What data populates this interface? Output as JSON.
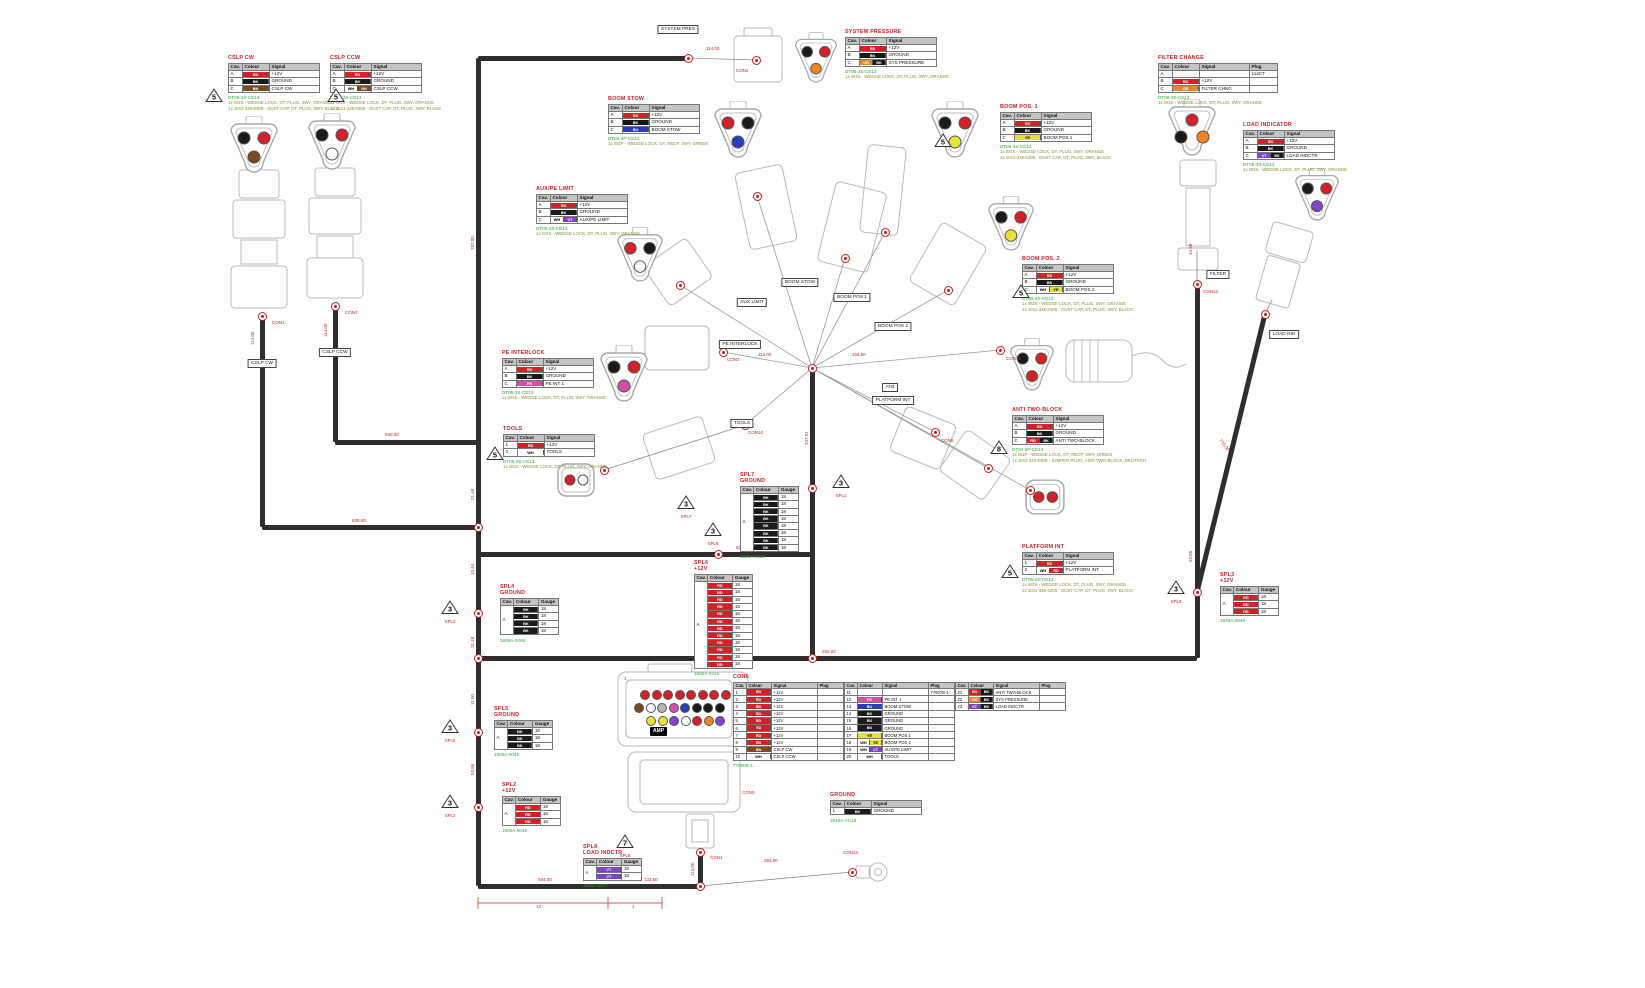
{
  "palette": {
    "RD": "#d22128",
    "BK": "#1a1a1a",
    "BN": "#7a4a21",
    "BU": "#2b3db5",
    "YE": "#e7e33b",
    "OR": "#ef8422",
    "PK": "#d44fa8",
    "VT": "#7e45c8",
    "WH": "#ffffff",
    "GY": "#b5b5b5"
  },
  "headers": {
    "pin": [
      "Cav.",
      "Colour",
      "Signal"
    ],
    "pin_plug": [
      "Cav.",
      "Colour",
      "Signal",
      "Plug"
    ],
    "splice": [
      "Cav.",
      "Colour",
      "Gauge"
    ]
  },
  "pin_tables": [
    {
      "id": "cslp-cw",
      "title": "CSLP CW",
      "x": 228,
      "y": 55,
      "cols": "pin",
      "rows": [
        [
          "A",
          "RD",
          "+12V"
        ],
        [
          "B",
          "BK",
          "GROUND"
        ],
        [
          "C",
          "BN",
          "CSLP CW"
        ]
      ],
      "part": "DT06-3S-CE13",
      "notes": [
        "1x W3S - WEDGE LOCK, DT, PLUG, 3WY, ORANGE",
        "1x 1011-345-0305 - DUST CAP, DT, PLUG, 3WY, BLACK"
      ]
    },
    {
      "id": "cslp-ccw",
      "title": "CSLP CCW",
      "x": 330,
      "y": 55,
      "cols": "pin",
      "rows": [
        [
          "A",
          "RD",
          "+12V"
        ],
        [
          "B",
          "BK",
          "GROUND"
        ],
        [
          "C",
          "WH/BN",
          "CSLP CCW"
        ]
      ],
      "part": "DT06-3S-CE13",
      "notes": [
        "1x W3S - WEDGE LOCK, DT, PLUG, 3WY, ORANGE",
        "1x 1011-345-0305 - DUST CAP, DT, PLUG, 3WY, BLACK"
      ]
    },
    {
      "id": "system-pressure",
      "title": "SYSTEM PRESSURE",
      "x": 845,
      "y": 29,
      "cols": "pin",
      "rows": [
        [
          "A",
          "RD",
          "+12V"
        ],
        [
          "B",
          "BK",
          "GROUND"
        ],
        [
          "C",
          "OR/BK",
          "SYS PRESSURE"
        ]
      ],
      "part": "DT06-3S-CE13",
      "notes": [
        "1x W3S - WEDGE LOCK, DT, PLUG, 3WY, ORANGE"
      ]
    },
    {
      "id": "boom-stow",
      "title": "BOOM STOW",
      "x": 608,
      "y": 96,
      "cols": "pin",
      "rows": [
        [
          "A",
          "RD",
          "+12V"
        ],
        [
          "B",
          "BK",
          "GROUND"
        ],
        [
          "C",
          "BU",
          "BOOM STOW"
        ]
      ],
      "part": "DT04-3P-CE13",
      "notes": [
        "1x W3P - WEDGE LOCK, DT, RECP, 3WY, GREEN"
      ]
    },
    {
      "id": "boom-pos-1",
      "title": "BOOM POS. 1",
      "x": 1000,
      "y": 104,
      "cols": "pin",
      "rows": [
        [
          "A",
          "RD",
          "+12V"
        ],
        [
          "B",
          "BK",
          "GROUND"
        ],
        [
          "C",
          "YE",
          "BOOM POS 1"
        ]
      ],
      "part": "DT06-3S-CE13",
      "notes": [
        "1x W3S - WEDGE LOCK, DT, PLUG, 3WY, ORANGE",
        "1x 1011-345-0305 - DUST CAP, DT, PLUG, 3WY, BLACK"
      ]
    },
    {
      "id": "boom-pos-2",
      "title": "BOOM POS. 2",
      "x": 1022,
      "y": 256,
      "cols": "pin",
      "rows": [
        [
          "A",
          "RD",
          "+12V"
        ],
        [
          "B",
          "BK",
          "GROUND"
        ],
        [
          "C",
          "WH/YE",
          "BOOM POS 2"
        ]
      ],
      "part": "DT06-3S-CE13",
      "notes": [
        "1x W3S - WEDGE LOCK, DT, PLUG, 3WY, ORANGE",
        "1x 1011-345-0305 - DUST CAP, DT, PLUG, 3WY, BLACK"
      ]
    },
    {
      "id": "aux-pe-limit",
      "title": "AUX/PE LIMIT",
      "x": 536,
      "y": 186,
      "cols": "pin",
      "rows": [
        [
          "A",
          "RD",
          "+12V"
        ],
        [
          "B",
          "BK",
          "GROUND"
        ],
        [
          "C",
          "WH/VT",
          "AUX/PE LIMIT"
        ]
      ],
      "part": "DT06-3S-CE13",
      "notes": [
        "1x W3S - WEDGE LOCK, DT, PLUG, 3WY, ORANGE"
      ]
    },
    {
      "id": "pe-interlock",
      "title": "PE INTERLOCK",
      "x": 502,
      "y": 350,
      "cols": "pin",
      "rows": [
        [
          "A",
          "RD",
          "+12V"
        ],
        [
          "B",
          "BK",
          "GROUND"
        ],
        [
          "C",
          "PK",
          "PE INT 1"
        ]
      ],
      "part": "DT06-3S-CE13",
      "notes": [
        "1x W3S - WEDGE LOCK, DT, PLUG, 3WY, ORANGE"
      ]
    },
    {
      "id": "tools",
      "title": "TOOLS",
      "x": 503,
      "y": 426,
      "cols": "pin",
      "rows": [
        [
          "1",
          "RD",
          "+12V"
        ],
        [
          "2",
          "WH",
          "TOOLS"
        ]
      ],
      "part": "DT06-2S-CE13",
      "notes": [
        "1x W2S - WEDGE LOCK, DT, PLUG, 2WY, ORANGE"
      ]
    },
    {
      "id": "filter-change",
      "title": "FILTER CHANGE",
      "x": 1158,
      "y": 55,
      "cols": "pin_plug",
      "rows": [
        [
          "A",
          "",
          "",
          "114CT"
        ],
        [
          "B",
          "RD",
          "+12V",
          ""
        ],
        [
          "C",
          "OR",
          "FILTER CHNG",
          ""
        ]
      ],
      "part": "DT06-3S-CE13",
      "notes": [
        "1x W3S - WEDGE LOCK, DT, PLUG, 3WY, ORANGE"
      ]
    },
    {
      "id": "load-indicator",
      "title": "LOAD INDICATOR",
      "x": 1243,
      "y": 122,
      "cols": "pin",
      "rows": [
        [
          "A",
          "RD",
          "+12V"
        ],
        [
          "B",
          "BK",
          "GROUND"
        ],
        [
          "C",
          "VT/BK",
          "LOAD INDCTR"
        ]
      ],
      "part": "DT06-3S-CE13",
      "notes": [
        "1x W3S - WEDGE LOCK, DT, PLUG, 3WY, ORANGE"
      ]
    },
    {
      "id": "anti-two-block",
      "title": "ANTI TWO-BLOCK",
      "x": 1012,
      "y": 407,
      "cols": "pin",
      "rows": [
        [
          "A",
          "RD",
          "+12V"
        ],
        [
          "B",
          "BK",
          "GROUND"
        ],
        [
          "C",
          "RD/BK",
          "ANTI TWO-BLOCK"
        ]
      ],
      "part": "DT04-3P-CE13",
      "notes": [
        "1x W3P - WEDGE LOCK, DT, RECP, 3WY, GREEN",
        "1x 1011-343-0305 - JUMPER PLUG, ANTI TWO-BLOCK, DEUTSCH"
      ]
    },
    {
      "id": "platform-int",
      "title": "PLATFORM INT",
      "x": 1022,
      "y": 544,
      "cols": "pin",
      "rows": [
        [
          "1",
          "RD",
          "+12V"
        ],
        [
          "2",
          "WH/RD",
          "PLATFORM INT"
        ]
      ],
      "part": "DT06-2S-CE13",
      "notes": [
        "1x W2S - WEDGE LOCK, DT, PLUG, 2WY, ORANGE",
        "1x 1011-345-0205 - DUST CAP, DT, PLUG, 2WY, BLACK"
      ]
    },
    {
      "id": "ground",
      "title": "GROUND",
      "x": 830,
      "y": 792,
      "cols": "pin",
      "rows": [
        [
          "1",
          "BK",
          "GROUND"
        ]
      ],
      "part": "1916A-YC18",
      "notes": []
    }
  ],
  "splice_tables": [
    {
      "id": "spl4",
      "title": "SPL4",
      "subtitle": "GROUND",
      "x": 500,
      "y": 584,
      "cav": "A",
      "colour": "BK",
      "gauge": "18",
      "count": 4,
      "part": "1926A-0046"
    },
    {
      "id": "spl5",
      "title": "SPL5",
      "subtitle": "GROUND",
      "x": 494,
      "y": 706,
      "cav": "A",
      "colour": "BK",
      "gauge": "18",
      "count": 3,
      "part": "1926A-0046"
    },
    {
      "id": "spl2",
      "title": "SPL2",
      "subtitle": "+12V",
      "x": 502,
      "y": 782,
      "cav": "A",
      "colour": "RD",
      "gauge": "18",
      "count": 3,
      "part": "1926A-0046"
    },
    {
      "id": "spl6",
      "title": "SPL6",
      "subtitle": "+12V",
      "x": 694,
      "y": 560,
      "cav": "A",
      "colour": "RD",
      "gauge": "18",
      "count": 12,
      "part": "1926A-0316"
    },
    {
      "id": "spl7",
      "title": "SPL7",
      "subtitle": "GROUND",
      "x": 740,
      "y": 472,
      "cav": "A",
      "colour": "BK",
      "gauge": "18",
      "count": 8,
      "part": "1926A-0316"
    },
    {
      "id": "spl3",
      "title": "SPL3",
      "subtitle": "+12V",
      "x": 1220,
      "y": 572,
      "cav": "A",
      "colour": "RD",
      "gauge": "18",
      "count": 3,
      "part": "1926A-0046"
    },
    {
      "id": "spl8",
      "title": "SPL8",
      "subtitle": "LOAD INDCTR",
      "x": 583,
      "y": 844,
      "cav": "A",
      "colour": "VT",
      "gauge": "18",
      "count": 2,
      "part": "1926A-0077"
    }
  ],
  "con6": {
    "title": "CON6",
    "x": 733,
    "y": 674,
    "note": "77900B-1",
    "groups": [
      {
        "rows": [
          [
            "1",
            "RD",
            "+12V",
            ""
          ],
          [
            "2",
            "RD",
            "+12V",
            ""
          ],
          [
            "3",
            "RD",
            "+12V",
            ""
          ],
          [
            "4",
            "RD",
            "+12V",
            ""
          ],
          [
            "5",
            "RD",
            "+12V",
            ""
          ],
          [
            "6",
            "RD",
            "+12V",
            ""
          ],
          [
            "7",
            "RD",
            "+12V",
            ""
          ],
          [
            "8",
            "RD",
            "+12V",
            ""
          ],
          [
            "9",
            "BN",
            "CSLP CW",
            ""
          ],
          [
            "10",
            "WH",
            "CSLP CCW",
            ""
          ]
        ]
      },
      {
        "rows": [
          [
            "11",
            "",
            "",
            "77907B-1"
          ],
          [
            "12",
            "PK",
            "PE INT 1",
            ""
          ],
          [
            "13",
            "BU",
            "BOOM STOW",
            ""
          ],
          [
            "14",
            "BK",
            "GROUND",
            ""
          ],
          [
            "15",
            "BK",
            "GROUND",
            ""
          ],
          [
            "16",
            "BK",
            "GROUND",
            ""
          ],
          [
            "17",
            "YE",
            "BOOM POS 1",
            ""
          ],
          [
            "18",
            "WH/YE",
            "BOOM POS 2",
            ""
          ],
          [
            "19",
            "WH/VT",
            "AUX/PE LIMIT",
            ""
          ],
          [
            "20",
            "WH",
            "TOOLS",
            ""
          ]
        ]
      },
      {
        "rows": [
          [
            "21",
            "RD/BK",
            "ANTI TWO-BLOCK",
            ""
          ],
          [
            "22",
            "OR/BK",
            "SYS PRESSURE",
            ""
          ],
          [
            "23",
            "VT/BK",
            "LOAD INDCTR",
            ""
          ]
        ]
      }
    ]
  },
  "amp": {
    "brand": "AMP",
    "pin_count": "23",
    "first_pin": "1",
    "pins": [
      "RD",
      "RD",
      "RD",
      "RD",
      "RD",
      "RD",
      "RD",
      "RD",
      "BN",
      "WH",
      "GY",
      "PK",
      "BU",
      "BK",
      "BK",
      "BK",
      "YE",
      "YE",
      "VT",
      "WH",
      "RD",
      "OR",
      "VT"
    ]
  },
  "boxed_labels": [
    {
      "text": "SYSTEM PRES",
      "x": 678,
      "y": 25
    },
    {
      "text": "CSLP CW",
      "x": 262,
      "y": 359
    },
    {
      "text": "CSLP CCW",
      "x": 335,
      "y": 348
    },
    {
      "text": "BOOM STOW",
      "x": 800,
      "y": 278
    },
    {
      "text": "AUX LIMIT",
      "x": 752,
      "y": 298
    },
    {
      "text": "PE INTERLOCK",
      "x": 740,
      "y": 340
    },
    {
      "text": "TOOLS",
      "x": 742,
      "y": 419
    },
    {
      "text": "BOOM POS 1",
      "x": 852,
      "y": 293
    },
    {
      "text": "BOOM POS 2",
      "x": 893,
      "y": 322
    },
    {
      "text": "ATB",
      "x": 890,
      "y": 383
    },
    {
      "text": "PLATFORM INT",
      "x": 893,
      "y": 396
    },
    {
      "text": "FILTER",
      "x": 1218,
      "y": 270
    },
    {
      "text": "LOAD IND",
      "x": 1284,
      "y": 330
    }
  ],
  "con_labels": [
    {
      "text": "CON1",
      "x": 272,
      "y": 320
    },
    {
      "text": "CON3",
      "x": 345,
      "y": 310
    },
    {
      "text": "CON2",
      "x": 736,
      "y": 68
    },
    {
      "text": "CON7",
      "x": 727,
      "y": 357
    },
    {
      "text": "CON9",
      "x": 941,
      "y": 438
    },
    {
      "text": "CON10",
      "x": 748,
      "y": 430
    },
    {
      "text": "CON11",
      "x": 1006,
      "y": 356
    },
    {
      "text": "CON12",
      "x": 1203,
      "y": 289
    },
    {
      "text": "CON5",
      "x": 742,
      "y": 790
    },
    {
      "text": "CON4",
      "x": 710,
      "y": 855
    },
    {
      "text": "CON13",
      "x": 843,
      "y": 850
    }
  ],
  "dims": [
    {
      "t": "114.00",
      "x": 706,
      "y": 46
    },
    {
      "t": "114.00",
      "x": 250,
      "y": 345,
      "r": "v"
    },
    {
      "t": "114.00",
      "x": 323,
      "y": 337,
      "r": "v"
    },
    {
      "t": "787.00",
      "x": 470,
      "y": 250,
      "r": "v"
    },
    {
      "t": "630.00",
      "x": 385,
      "y": 432
    },
    {
      "t": "635.00",
      "x": 352,
      "y": 518
    },
    {
      "t": "21.48",
      "x": 470,
      "y": 500,
      "r": "v"
    },
    {
      "t": "13.44",
      "x": 470,
      "y": 575,
      "r": "v"
    },
    {
      "t": "31.48",
      "x": 470,
      "y": 648,
      "r": "v"
    },
    {
      "t": "11.00",
      "x": 470,
      "y": 705,
      "r": "v"
    },
    {
      "t": "53.86",
      "x": 470,
      "y": 775,
      "r": "v"
    },
    {
      "t": "254.00",
      "x": 822,
      "y": 649
    },
    {
      "t": "114.00",
      "x": 758,
      "y": 352
    },
    {
      "t": "154.00",
      "x": 852,
      "y": 352
    },
    {
      "t": "137.91",
      "x": 804,
      "y": 445,
      "r": "v"
    },
    {
      "t": "92.60",
      "x": 736,
      "y": 545
    },
    {
      "t": "44.58",
      "x": 1188,
      "y": 255,
      "r": "v"
    },
    {
      "t": "53.86",
      "x": 1188,
      "y": 562,
      "r": "v"
    },
    {
      "t": "770.00",
      "x": 1222,
      "y": 438,
      "r": "d"
    },
    {
      "t": "584.00",
      "x": 538,
      "y": 877
    },
    {
      "t": "132.50",
      "x": 644,
      "y": 877
    },
    {
      "t": "114.00",
      "x": 690,
      "y": 876,
      "r": "v"
    },
    {
      "t": "364.00",
      "x": 764,
      "y": 858
    },
    {
      "t": "12",
      "x": 536,
      "y": 904
    },
    {
      "t": "1",
      "x": 632,
      "y": 904
    }
  ],
  "triangles": [
    {
      "n": "5",
      "x": 205,
      "y": 88
    },
    {
      "n": "5",
      "x": 327,
      "y": 88
    },
    {
      "n": "5",
      "x": 934,
      "y": 133
    },
    {
      "n": "5",
      "x": 1012,
      "y": 284
    },
    {
      "n": "5",
      "x": 486,
      "y": 446
    },
    {
      "n": "8",
      "x": 990,
      "y": 440
    },
    {
      "n": "5",
      "x": 1001,
      "y": 564
    },
    {
      "n": "3",
      "x": 441,
      "y": 600,
      "label": "SPL4"
    },
    {
      "n": "3",
      "x": 441,
      "y": 719,
      "label": "SPL5"
    },
    {
      "n": "3",
      "x": 441,
      "y": 794,
      "label": "SPL2"
    },
    {
      "n": "3",
      "x": 704,
      "y": 522,
      "label": "SPL6"
    },
    {
      "n": "3",
      "x": 832,
      "y": 474,
      "label": "SPL1"
    },
    {
      "n": "3",
      "x": 677,
      "y": 495,
      "label": "SPL7"
    },
    {
      "n": "3",
      "x": 1167,
      "y": 580,
      "label": "SPL3"
    },
    {
      "n": "7",
      "x": 616,
      "y": 834,
      "label": "SPL8"
    }
  ],
  "tri_connectors": [
    {
      "x": 228,
      "y": 116,
      "s": 52,
      "pins": [
        "BK",
        "RD",
        "BN"
      ]
    },
    {
      "x": 306,
      "y": 113,
      "s": 52,
      "pins": [
        "BK",
        "RD",
        "WH"
      ]
    },
    {
      "x": 793,
      "y": 32,
      "s": 46,
      "pins": [
        "BK",
        "RD",
        "OR"
      ]
    },
    {
      "x": 712,
      "y": 101,
      "s": 52,
      "pins": [
        "RD",
        "BK",
        "BU"
      ]
    },
    {
      "x": 929,
      "y": 101,
      "s": 52,
      "pins": [
        "BK",
        "RD",
        "YE"
      ]
    },
    {
      "x": 986,
      "y": 196,
      "s": 50,
      "pins": [
        "BK",
        "RD",
        "YE"
      ]
    },
    {
      "x": 615,
      "y": 227,
      "s": 50,
      "pins": [
        "RD",
        "BK",
        "WH"
      ]
    },
    {
      "x": 598,
      "y": 345,
      "s": 52,
      "pins": [
        "BK",
        "RD",
        "PK"
      ]
    },
    {
      "x": 1008,
      "y": 338,
      "s": 48,
      "pins": [
        "BK",
        "RD",
        "RD"
      ]
    },
    {
      "x": 1166,
      "y": 99,
      "s": 52,
      "pins": [
        "RD",
        "BK",
        "OR"
      ],
      "inv": true
    },
    {
      "x": 1293,
      "y": 168,
      "s": 48,
      "pins": [
        "BK",
        "RD",
        "VT"
      ]
    }
  ],
  "two_pin_connectors": [
    {
      "x": 556,
      "y": 460,
      "s": 40,
      "pins": [
        "RD",
        "WH"
      ]
    },
    {
      "x": 1024,
      "y": 476,
      "s": 42,
      "pins": [
        "RD",
        "RD"
      ]
    }
  ]
}
